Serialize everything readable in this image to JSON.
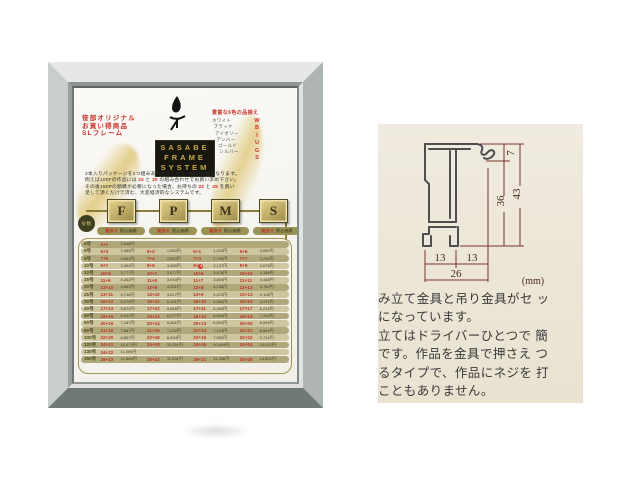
{
  "poster": {
    "promo_lines": [
      "笹部オリジナル",
      "お買い得商品",
      "SLフレーム"
    ],
    "colors": {
      "header": "豊富な6色の品揃え",
      "names": [
        "ホワイト",
        "ブラック",
        "アイボリー",
        "アンバー",
        "ゴールド",
        "シルバー"
      ],
      "letters": [
        "W",
        "B",
        "I",
        "U",
        "G",
        "S"
      ]
    },
    "logo_lines": [
      "SASABE",
      "FRAME",
      "SYSTEM"
    ],
    "intro_lines": [
      [
        {
          "t": "2本入りパッケージを2つ組みあわせることで一組の額縁となります。"
        }
      ],
      [
        {
          "t": "例えば100Fの作品には "
        },
        {
          "t": "22",
          "red": true
        },
        {
          "t": " と "
        },
        {
          "t": "20",
          "red": true
        },
        {
          "t": " の組み合わせでお買い求め下さい。"
        }
      ],
      [
        {
          "t": "その後150Pの額縁が必要になった場合、お持ちの "
        },
        {
          "t": "22",
          "red": true
        },
        {
          "t": " と "
        },
        {
          "t": "25",
          "red": true
        },
        {
          "t": " を買い"
        }
      ],
      [
        {
          "t": "足して頂くだけで済む、大変経済的なシステムです。"
        }
      ]
    ],
    "size_circle": "号数",
    "fpms": [
      "F",
      "P",
      "M",
      "S"
    ],
    "col_header": {
      "combo": "組合せ",
      "price": "税込価格"
    },
    "table": {
      "size_suffix": "号",
      "rows": [
        {
          "size": "4",
          "cells": [
            [
              "4+1",
              "2,048円"
            ],
            null,
            null,
            null
          ]
        },
        {
          "size": "6",
          "cells": [
            [
              "6+3",
              "1,965円"
            ],
            [
              "6+2",
              "1,950円"
            ],
            [
              "6+1",
              "1,424円"
            ],
            [
              "6+6",
              "3,050円"
            ]
          ]
        },
        {
          "size": "8",
          "cells": [
            [
              "7+5",
              "2,961円"
            ],
            [
              "7+4",
              "2,853円"
            ],
            [
              "7+3",
              "2,790円"
            ],
            [
              "7+7",
              "3,290円"
            ]
          ]
        },
        {
          "size": "10",
          "cells": [
            [
              "9+7",
              "3,464円"
            ],
            [
              "9+6",
              "3,365円"
            ],
            [
              "9+4",
              "3,137円",
              "dot"
            ],
            [
              "9+9",
              "3,678円"
            ]
          ]
        },
        {
          "size": "12",
          "cells": [
            [
              "10+8",
              "3,777円"
            ],
            [
              "10+7",
              "3,677円"
            ],
            [
              "10+6",
              "3,578円"
            ],
            [
              "10+10",
              "4,158円"
            ]
          ]
        },
        {
          "size": "15",
          "cells": [
            [
              "11+9",
              "4,262円"
            ],
            [
              "11+8",
              "3,944円"
            ],
            [
              "11+7",
              "3,844円"
            ],
            [
              "11+11",
              "4,448円"
            ]
          ]
        },
        {
          "size": "20",
          "cells": [
            [
              "12+10",
              "4,653円"
            ],
            [
              "12+9",
              "4,251円"
            ],
            [
              "12+8",
              "4,138円"
            ],
            [
              "12+12",
              "4,782円"
            ]
          ]
        },
        {
          "size": "25",
          "cells": [
            [
              "13+11",
              "4,746円"
            ],
            [
              "13+10",
              "4,617円"
            ],
            [
              "13+9",
              "4,474円"
            ],
            [
              "13+13",
              "5,118円"
            ]
          ]
        },
        {
          "size": "30",
          "cells": [
            [
              "15+12",
              "5,274円"
            ],
            [
              "15+11",
              "5,161円"
            ],
            [
              "15+10",
              "4,984円"
            ],
            [
              "15+15",
              "5,974円"
            ]
          ]
        },
        {
          "size": "40",
          "cells": [
            [
              "17+13",
              "5,872円"
            ],
            [
              "17+12",
              "5,846円"
            ],
            [
              "17+11",
              "5,264円"
            ],
            [
              "17+17",
              "6,214円"
            ]
          ]
        },
        {
          "size": "50",
          "cells": [
            [
              "19+15",
              "6,942円"
            ],
            [
              "19+13",
              "6,277円"
            ],
            [
              "19+12",
              "6,064円"
            ],
            [
              "19+19",
              "7,418円"
            ]
          ]
        },
        {
          "size": "60",
          "cells": [
            [
              "20+16",
              "7,187円"
            ],
            [
              "20+14",
              "6,861円"
            ],
            [
              "20+13",
              "6,594円"
            ],
            [
              "20+20",
              "8,094円"
            ]
          ]
        },
        {
          "size": "80",
          "cells": [
            [
              "21+18",
              "7,867円"
            ],
            [
              "21+16",
              "7,432円"
            ],
            [
              "21+14",
              "7,194円"
            ],
            [
              "21+21",
              "8,554円"
            ]
          ]
        },
        {
          "size": "100",
          "cells": [
            [
              "22+20",
              "8,857円"
            ],
            [
              "22+18",
              "8,534円"
            ],
            [
              "22+16",
              "7,952円"
            ],
            [
              "22+22",
              "9,714円"
            ]
          ]
        },
        {
          "size": "120",
          "cells": [
            [
              "24+21",
              "10,473円"
            ],
            [
              "24+18",
              "11,051円"
            ],
            [
              "24+16",
              "10,094円"
            ],
            [
              "24+24",
              "12,012円"
            ]
          ]
        },
        {
          "size": "130",
          "cells": [
            [
              "24+22",
              "11,090円"
            ],
            null,
            null,
            null
          ]
        },
        {
          "size": "150",
          "cells": [
            [
              "25+23",
              "12,884円"
            ],
            [
              "25+22",
              "11,831円"
            ],
            [
              "25+21",
              "11,286円"
            ],
            [
              "25+25",
              "14,852円"
            ]
          ]
        }
      ]
    }
  },
  "spec": {
    "dims": {
      "d7": "7",
      "d36": "36",
      "d43": "43",
      "d13a": "13",
      "d13b": "13",
      "d26": "26",
      "unit": "(mm)"
    },
    "desc_lines": [
      "み立て金具と吊り金具がセ ッ",
      "になっています。",
      "立てはドライバーひとつで 簡",
      "です。作品を金具で押さえ つ",
      "るタイプで、作品にネジを 打",
      "こともありません。"
    ]
  },
  "colors_hex": {
    "accent_red": "#cb3028",
    "gold": "#c9a84c",
    "olive_row": "#cdc69e",
    "panel_beige": "#ece6d7",
    "dim_line": "#7b3228"
  }
}
